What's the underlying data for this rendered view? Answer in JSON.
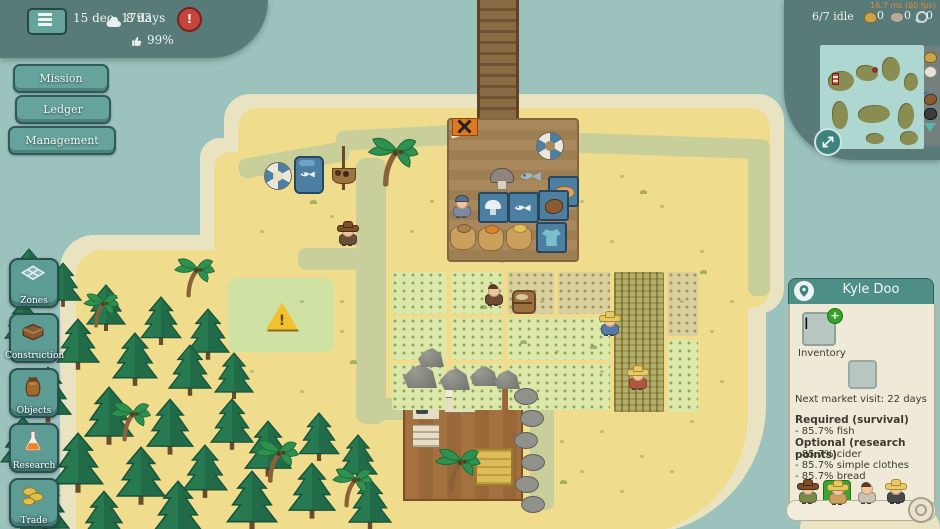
{
  "hud": {
    "perf_text": "16.7 ms (60 fps)",
    "date": "15 dec. 1793",
    "weather": "8 days",
    "happiness": "99%",
    "idle": "6/7 idle",
    "resource_counts": [
      "0",
      "0",
      "0"
    ],
    "alert_glyph": "!"
  },
  "menu_buttons": {
    "mission": "Mission",
    "ledger": "Ledger",
    "management": "Management"
  },
  "toolbar": {
    "zones": "Zones",
    "construction": "Construction",
    "objects": "Objects",
    "research": "Research",
    "trade": "Trade"
  },
  "minimap": {
    "title": "Great Keppel Island"
  },
  "panel": {
    "title": "Kyle Doo",
    "inventory_badge": "I",
    "inventory_plus": "+",
    "inventory_label": "Inventory",
    "market_visit": "Next market visit: 22 days",
    "required_header": "Required (survival)",
    "required_1": "- 85.7% fish",
    "optional_header": "Optional (research points)",
    "optional_1": "- 85.7% cider",
    "optional_2": "- 85.7% simple clothes",
    "optional_3": "- 85.7% bread",
    "warning_glyph": "!"
  },
  "colors": {
    "ocean": "#9cc2bd",
    "beach": "#eae3c2",
    "sand": "#f0dc8d",
    "path": "#c9cf9a",
    "panel_header": "#4d8f87",
    "paper": "#efe9d8",
    "highlight_green": "#3aa52f",
    "alert_red": "#c2463b"
  }
}
